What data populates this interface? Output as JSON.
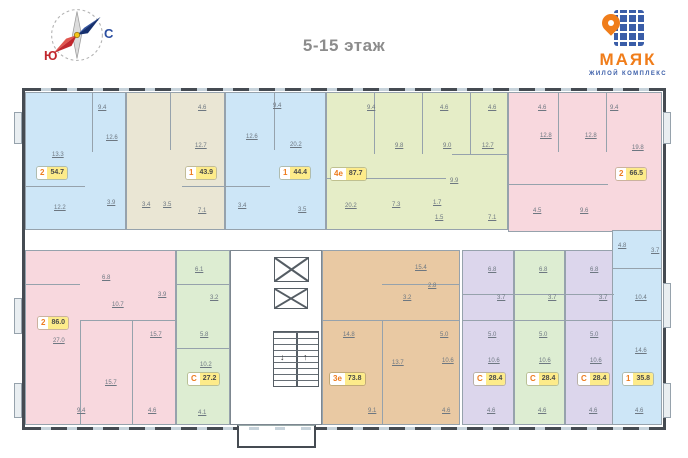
{
  "header": {
    "title": "5-15 этаж",
    "compass": {
      "south": "Ю",
      "north": "С"
    },
    "logo": {
      "name": "МАЯК",
      "subtitle": "ЖИЛОЙ КОМПЛЕКС"
    }
  },
  "colors": {
    "blue": "#cde6f7",
    "beige": "#eae6d4",
    "green": "#e5edc7",
    "green2": "#ddedd2",
    "pink": "#f8d8de",
    "tan": "#e9c9a3",
    "lavender": "#dcd6ec",
    "accent_orange": "#ee7c1e",
    "badge_yellow": "#fdeb8a",
    "logo_orange": "#f07d1a",
    "logo_blue": "#3a5da8",
    "compass_red": "#c1272d",
    "compass_blue": "#2b4ea0",
    "wall": "#454b52",
    "title_gray": "#8c8c8c"
  },
  "plan": {
    "units": [
      {
        "rooms": "2",
        "area": "54.7",
        "dims": [
          "9.4",
          "12.6",
          "13.3",
          "12.2",
          "3.9"
        ]
      },
      {
        "rooms": "1",
        "area": "43.9",
        "dims": [
          "4.6",
          "12.7",
          "7.1",
          "3.4",
          "3.5"
        ]
      },
      {
        "rooms": "1",
        "area": "44.4",
        "dims": [
          "9.4",
          "12.6",
          "20.2",
          "3.4",
          "3.5"
        ]
      },
      {
        "rooms": "4е",
        "area": "87.7",
        "dims": [
          "9.4",
          "4.6",
          "4.6",
          "9.8",
          "9.0",
          "12.7",
          "9.9",
          "20.2",
          "7.3",
          "1.7",
          "1.5",
          "7.1"
        ]
      },
      {
        "rooms": "2",
        "area": "66.5",
        "dims": [
          "4.6",
          "9.4",
          "12.8",
          "12.8",
          "19.8",
          "4.5",
          "9.6"
        ]
      },
      {
        "rooms": "2",
        "area": "86.0",
        "dims": [
          "6.8",
          "10.7",
          "3.9",
          "15.7",
          "27.0",
          "15.7",
          "9.4",
          "4.6"
        ]
      },
      {
        "rooms": "С",
        "area": "27.2",
        "dims": [
          "6.1",
          "3.2",
          "5.8",
          "10.2",
          "4.1"
        ]
      },
      {
        "rooms": "3е",
        "area": "73.8",
        "dims": [
          "15.4",
          "2.8",
          "3.2",
          "14.8",
          "5.0",
          "13.7",
          "10.6",
          "9.1",
          "4.6"
        ]
      },
      {
        "rooms": "С",
        "area": "28.4",
        "dims": [
          "6.8",
          "3.7",
          "5.0",
          "10.6",
          "4.6"
        ]
      },
      {
        "rooms": "С",
        "area": "28.4",
        "dims": [
          "6.8",
          "3.7",
          "5.0",
          "10.6",
          "4.6"
        ]
      },
      {
        "rooms": "С",
        "area": "28.4",
        "dims": [
          "6.8",
          "3.7",
          "5.0",
          "10.6",
          "4.6"
        ]
      },
      {
        "rooms": "1",
        "area": "35.8",
        "dims": [
          "4.8",
          "3.7",
          "10.4",
          "14.6",
          "4.6"
        ]
      }
    ],
    "core": {
      "elevators": 2,
      "staircase": true
    }
  }
}
